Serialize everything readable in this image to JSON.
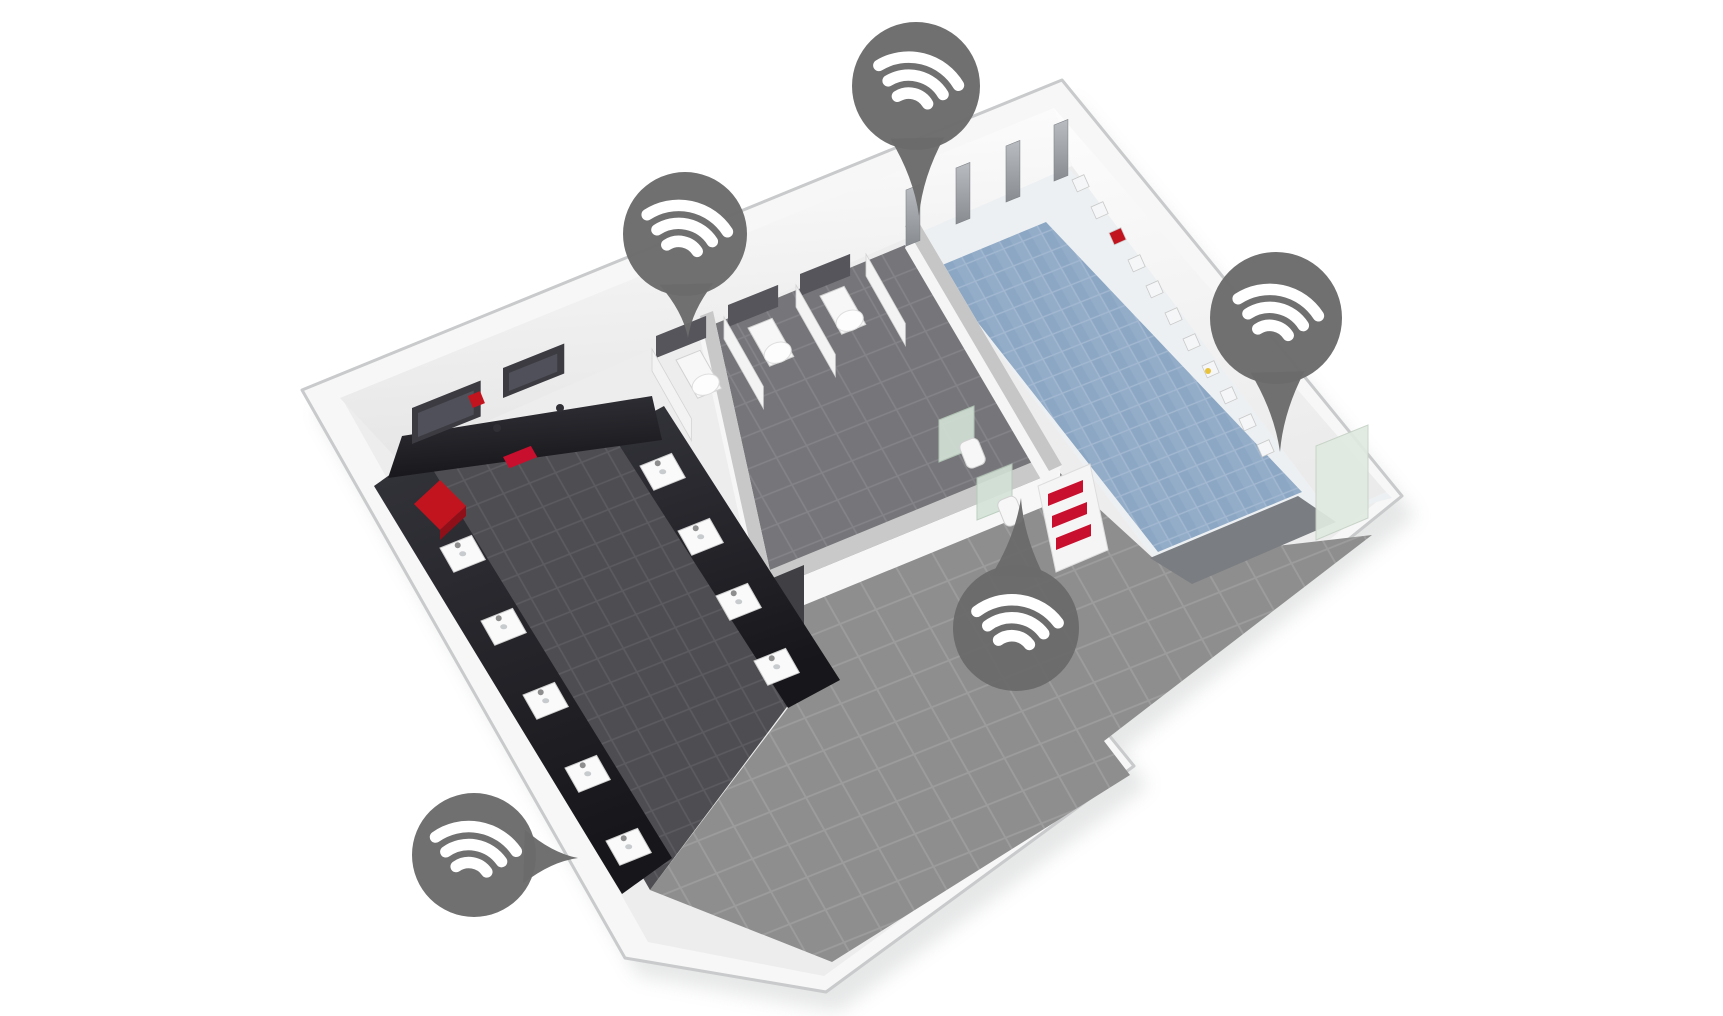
{
  "illustration": {
    "kind": "isometric-sanitary-facility-floorplan",
    "rooms": [
      "washroom",
      "toilet-stalls",
      "urinal-area",
      "shower-room",
      "corridor"
    ]
  },
  "colors": {
    "background": "#ffffff",
    "marker": "#6b6b6b",
    "marker_glyph": "#ffffff",
    "rim": "#f7f7f7",
    "bevel": "#c8cacb",
    "base": "#ededed",
    "wall_white": "#ffffff",
    "wall_shade": "#e8e8e8",
    "corridor_tile": "#8e8e8e",
    "corridor_grout": "#9c9c9c",
    "room_tile": "#76767a",
    "room_grout": "#848488",
    "walkway_tile": "#4e4e52",
    "walkway_grout": "#5c5c60",
    "blue_tile": "#8ca7c4",
    "blue_tile_alt": "#93adc9",
    "blue_grout": "#a3b8d1",
    "shower_border": "#edf0f2",
    "shower_edge_band": "#7a7d81",
    "counter_top": "#33333a",
    "counter_deep": "#17171b",
    "mirror": "#3b3b41",
    "cistern": "#55555b",
    "panel_light": "#b9bdc1",
    "panel_dark": "#888c90",
    "divider_green": "#d3e2d6",
    "divider_edge": "#b7cbba",
    "fixture_white": "#f7f7f7",
    "fixture_stroke": "#d2d2d2",
    "accent_red": "#c2141f",
    "accent_red_dark": "#90101a",
    "towel_red": "#c8102e",
    "door_slot": "#3f3f44",
    "glass_door": "#e0eae0"
  },
  "markers": [
    {
      "id": "marker-shower-controls",
      "points_to": "shower-control-panel",
      "cx": 916,
      "cy": 86,
      "r": 64,
      "rot": 14,
      "tip": [
        919,
        216
      ]
    },
    {
      "id": "marker-toilets",
      "points_to": "toilet-stalls",
      "cx": 685,
      "cy": 234,
      "r": 62,
      "rot": 12,
      "tip": [
        688,
        338
      ]
    },
    {
      "id": "marker-dispensers",
      "points_to": "wall-dispensers",
      "cx": 1276,
      "cy": 318,
      "r": 66,
      "rot": 12,
      "tip": [
        1280,
        452
      ]
    },
    {
      "id": "marker-urinals",
      "points_to": "urinals",
      "cx": 1016,
      "cy": 628,
      "r": 63,
      "rot": 8,
      "tip": [
        1021,
        498
      ]
    },
    {
      "id": "marker-washbasins",
      "points_to": "washbasins",
      "cx": 474,
      "cy": 855,
      "r": 62,
      "rot": 10,
      "tip": [
        578,
        858
      ]
    }
  ],
  "fixtures": {
    "mirrors": [
      [
        412,
        408,
        74,
        36
      ],
      [
        503,
        368,
        66,
        30
      ]
    ],
    "cistern_panels": [
      [
        656,
        336
      ],
      [
        728,
        305
      ],
      [
        800,
        274
      ]
    ],
    "toilets": [
      [
        676,
        360
      ],
      [
        748,
        328
      ],
      [
        820,
        296
      ]
    ],
    "stall_partitions": [
      [
        652,
        349
      ],
      [
        724,
        317
      ],
      [
        796,
        285
      ],
      [
        866,
        254
      ]
    ],
    "urinal_dividers": [
      [
        974,
        406
      ],
      [
        1012,
        464
      ]
    ],
    "urinals": [
      [
        958,
        444
      ],
      [
        996,
        502
      ]
    ],
    "shower_panels": [
      [
        906,
        190
      ],
      [
        956,
        168
      ],
      [
        1006,
        146
      ],
      [
        1054,
        125
      ]
    ],
    "wall_dispensers": [
      {
        "x": 1072,
        "y": 180,
        "c": "#f4f6f7"
      },
      {
        "x": 1091,
        "y": 207,
        "c": "#f4f6f7"
      },
      {
        "x": 1109,
        "y": 233,
        "c": "#c2141f"
      },
      {
        "x": 1128,
        "y": 260,
        "c": "#f4f6f7"
      },
      {
        "x": 1146,
        "y": 286,
        "c": "#f4f6f7"
      },
      {
        "x": 1165,
        "y": 313,
        "c": "#f4f6f7"
      },
      {
        "x": 1183,
        "y": 339,
        "c": "#f4f6f7"
      },
      {
        "x": 1202,
        "y": 366,
        "c": "#f4f6f7",
        "dot": "#e8c23a"
      },
      {
        "x": 1220,
        "y": 392,
        "c": "#f4f6f7"
      },
      {
        "x": 1239,
        "y": 419,
        "c": "#f4f6f7"
      },
      {
        "x": 1257,
        "y": 445,
        "c": "#f4f6f7"
      }
    ],
    "sinks_sw": [
      [
        440,
        548
      ],
      [
        481,
        621
      ],
      [
        523,
        695
      ],
      [
        565,
        768
      ],
      [
        606,
        841
      ]
    ],
    "sinks_inner": [
      [
        640,
        466
      ],
      [
        678,
        531
      ],
      [
        716,
        596
      ],
      [
        754,
        661
      ]
    ],
    "counter_red_box": [
      414,
      504
    ],
    "counter_red_towel": [
      503,
      457
    ],
    "wall_red_dispenser": [
      468,
      396
    ],
    "towel_shelf": {
      "x": 1038,
      "y": 478,
      "towels": 3
    },
    "glass_door": [
      1316,
      446
    ]
  }
}
